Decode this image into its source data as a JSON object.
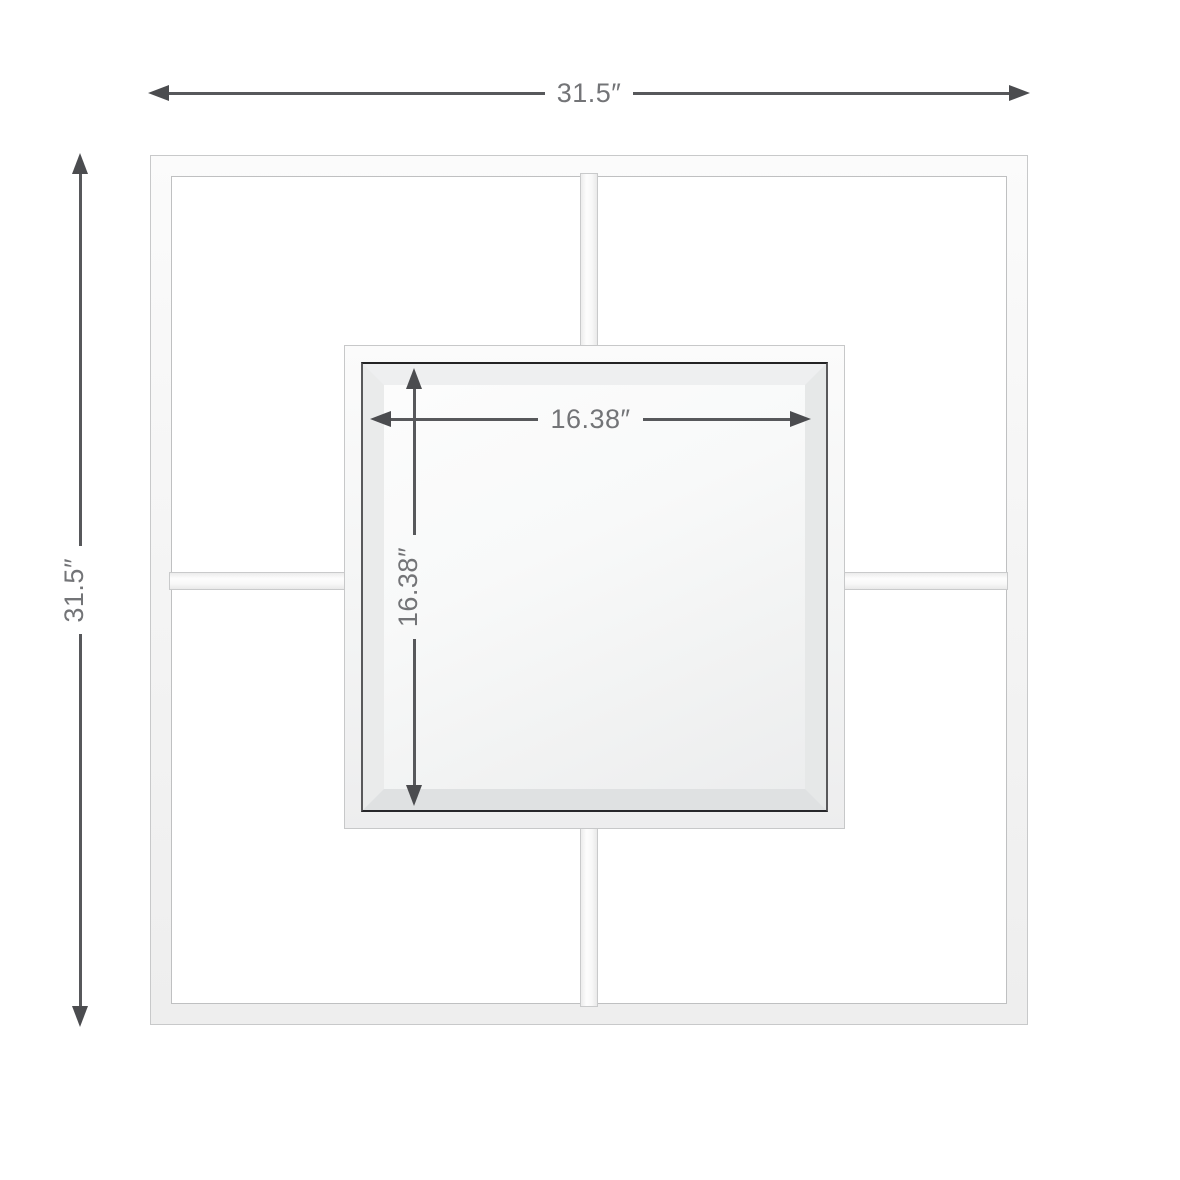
{
  "diagram": {
    "unit": "inches",
    "overall": {
      "width_label": "31.5″",
      "height_label": "31.5″",
      "width_value": 31.5,
      "height_value": 31.5
    },
    "mirror": {
      "width_label": "16.38″",
      "height_label": "16.38″",
      "width_value": 16.38,
      "height_value": 16.38
    },
    "colors": {
      "background": "#ffffff",
      "dimension_line": "#57585b",
      "dimension_arrow": "#4b4c4f",
      "dimension_text": "#737477",
      "frame_outline": "#c8c9ca",
      "frame_fill": "#f6f6f6",
      "mirror_edge": "#2a2a2b",
      "mirror_bevel": "#e6e8e8",
      "mirror_face": "#f4f5f5"
    }
  }
}
